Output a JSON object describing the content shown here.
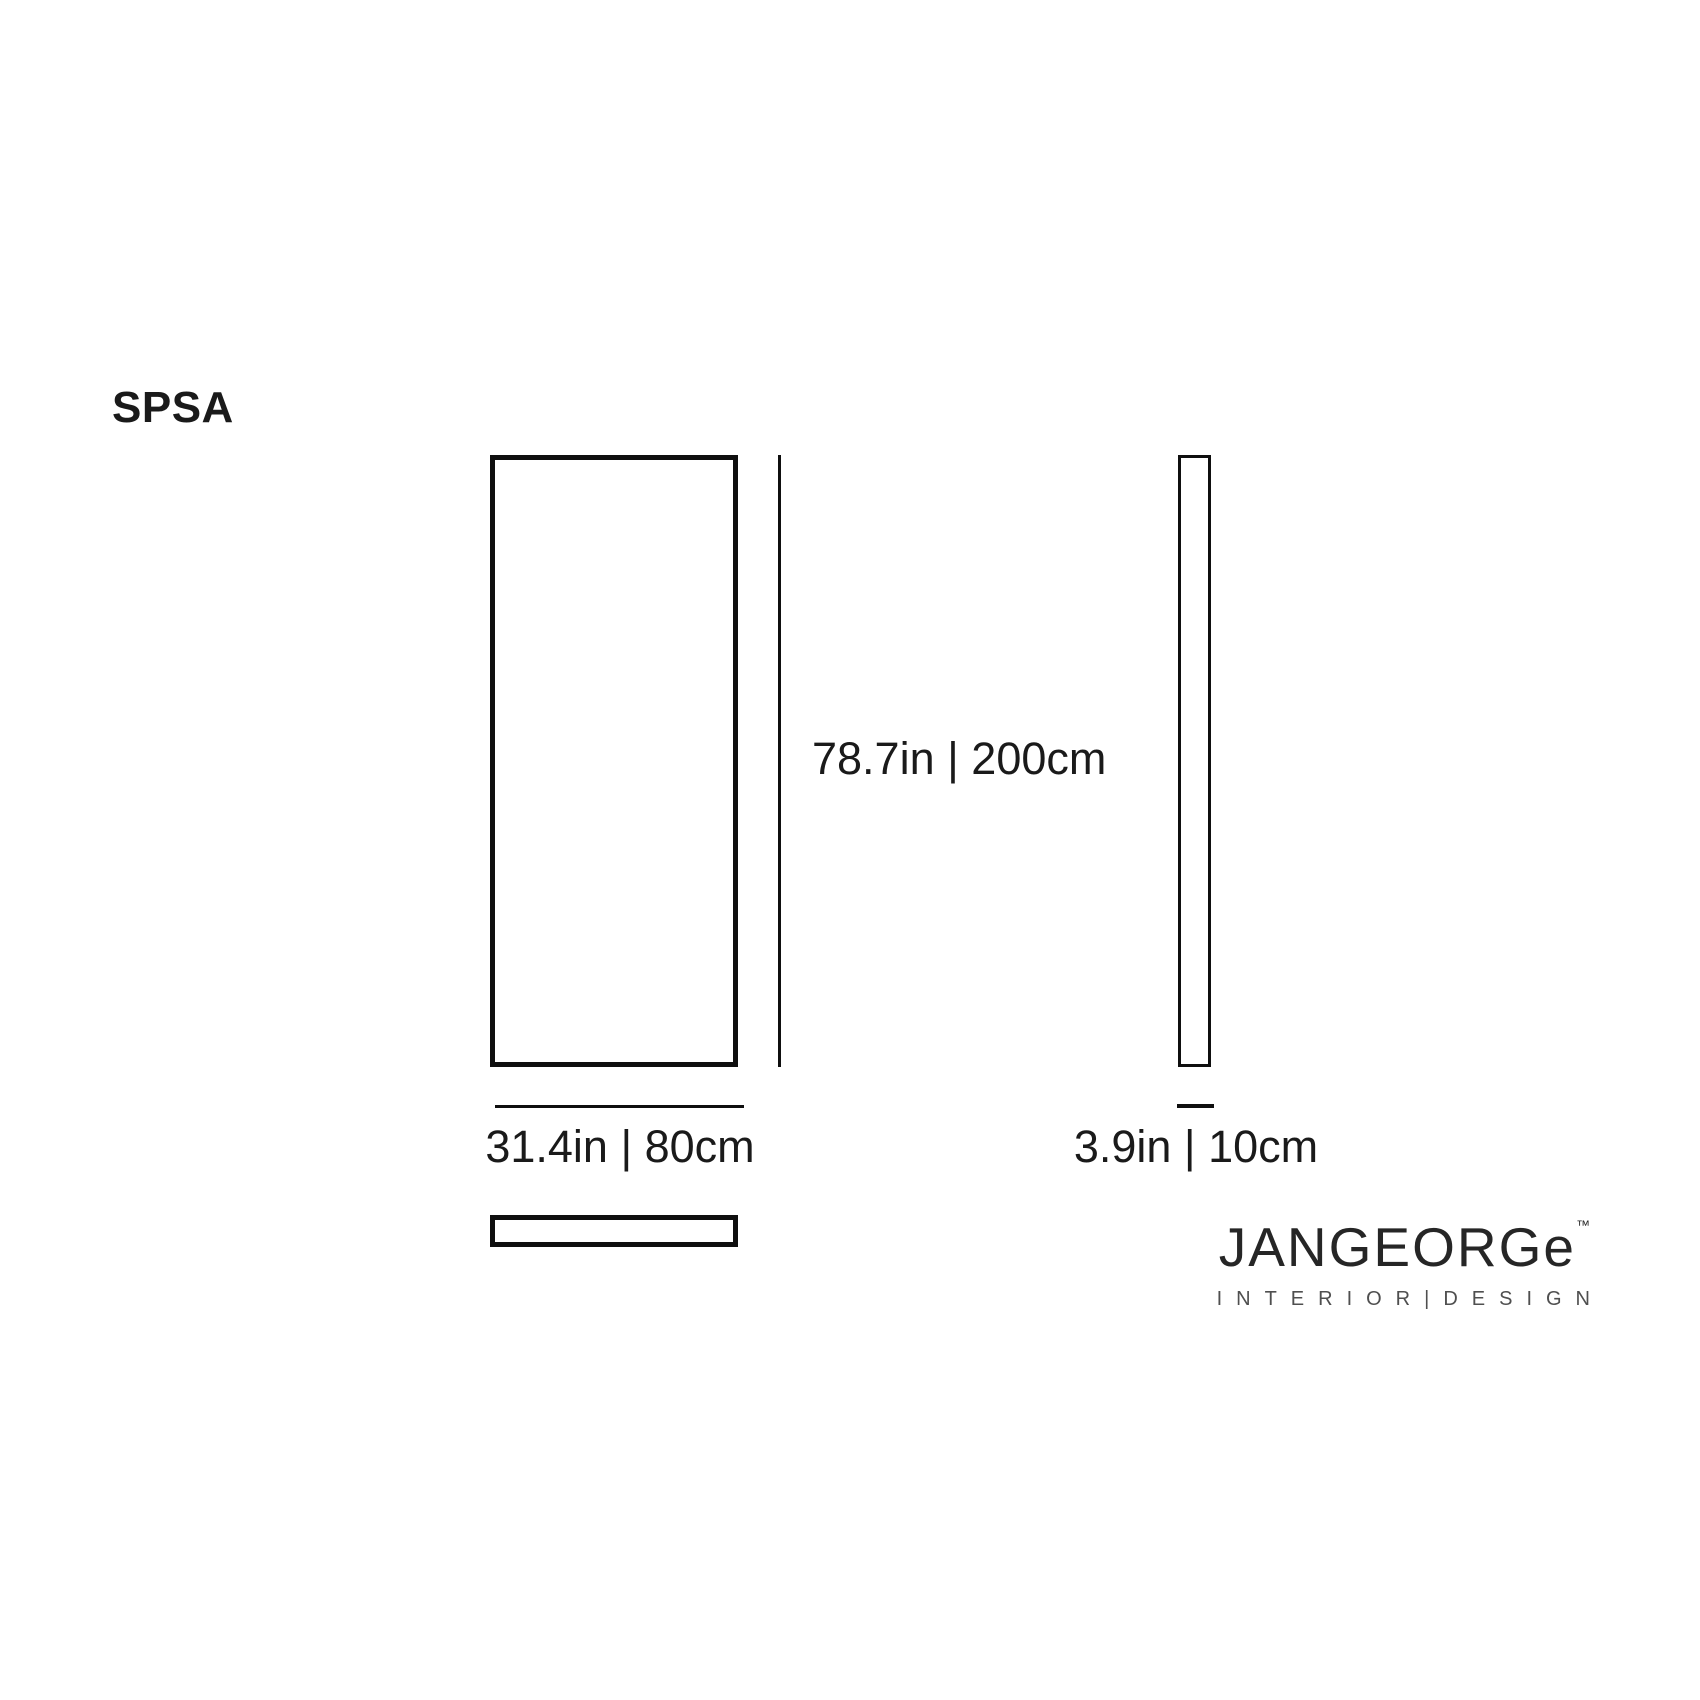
{
  "header": {
    "product_code": "SPSA"
  },
  "dimensions": {
    "height": "78.7in | 200cm",
    "width": "31.4in | 80cm",
    "depth": "3.9in | 10cm"
  },
  "logo": {
    "brand": "JANGEORGe",
    "trademark": "™",
    "tagline": "INTERIOR|DESIGN"
  },
  "colors": {
    "background": "#ffffff",
    "line": "#0f0f0f",
    "text": "#1a1a1a",
    "brand": "#262626",
    "tagline": "#4f4f4f"
  }
}
